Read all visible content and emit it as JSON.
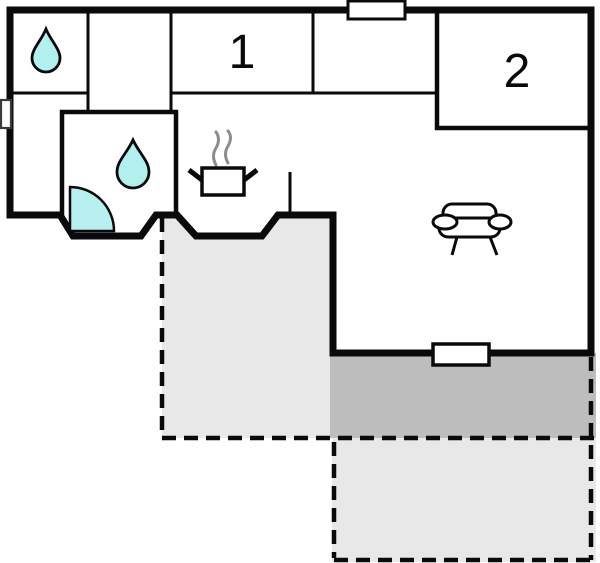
{
  "floor_plan": {
    "rooms": [
      {
        "label": "1"
      },
      {
        "label": "2"
      }
    ],
    "colors": {
      "wall": "#0a0a0a",
      "floor": "#ffffff",
      "water": "#b2f0ee",
      "door_swing": "#b8f0f0",
      "terrace_light": "#e8e8e8",
      "terrace_dark": "#bdbdbd",
      "steam": "#8c8c8c",
      "background": "#ffffff"
    },
    "icons": {
      "bathroom": "water-drop-icon",
      "shower_room": "water-drop-icon",
      "kitchen": "stove-pot-steam-icon",
      "living_room": "sofa-icon",
      "entrance": "door-swing-quarter-circle-icon",
      "openings": "window-icon"
    }
  }
}
